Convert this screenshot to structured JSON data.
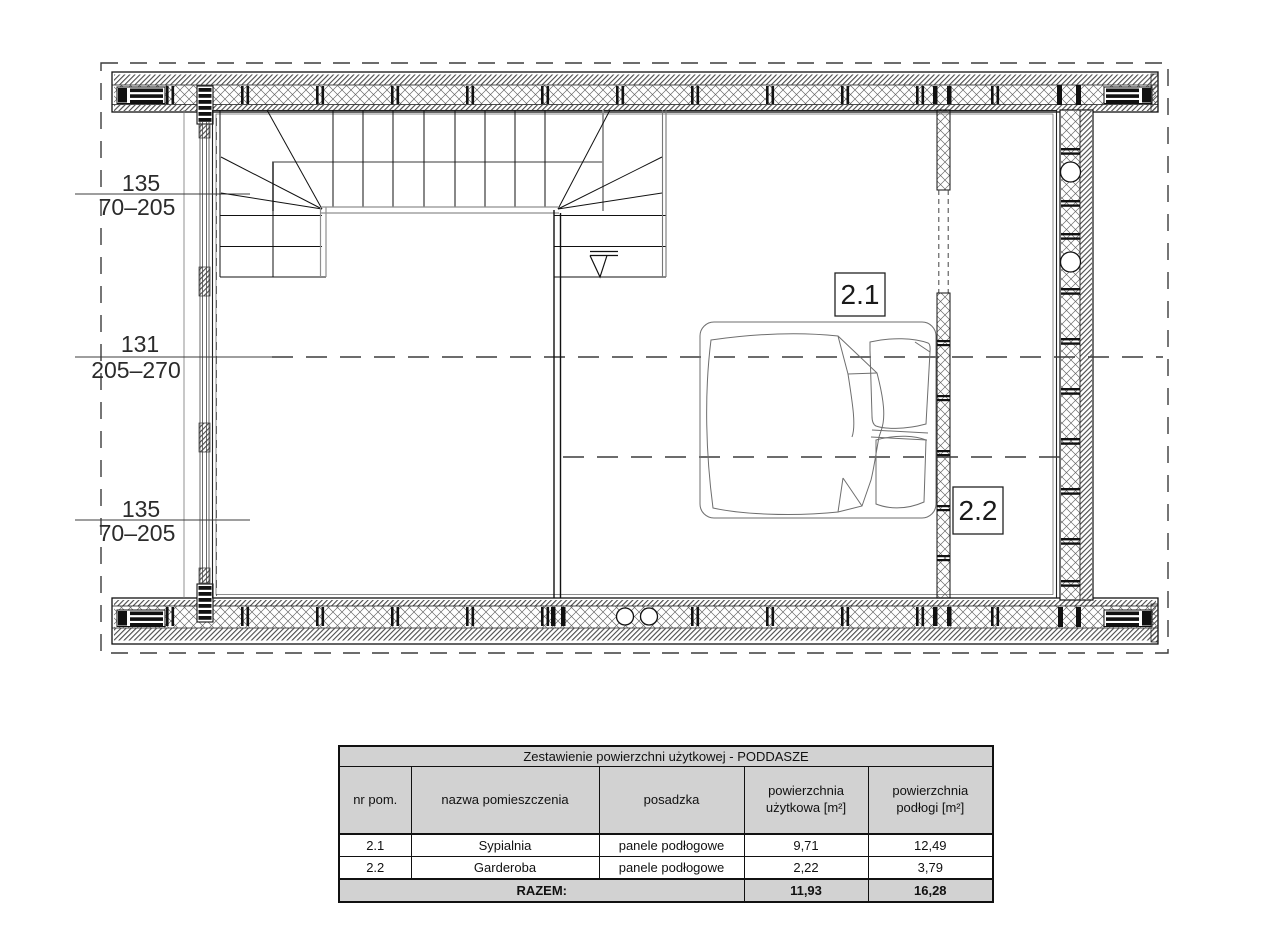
{
  "plan": {
    "dimension_labels": [
      {
        "height": "135",
        "range": "70–205"
      },
      {
        "height": "131",
        "range": "205–270"
      },
      {
        "height": "135",
        "range": "70–205"
      }
    ],
    "room_labels": {
      "bedroom": "2.1",
      "wardrobe": "2.2"
    }
  },
  "table": {
    "title": "Zestawienie powierzchni użytkowej - PODDASZE",
    "columns": [
      "nr pom.",
      "nazwa pomieszczenia",
      "posadzka",
      "powierzchnia użytkowa [m²]",
      "powierzchnia podłogi [m²]"
    ],
    "rows": [
      {
        "nr": "2.1",
        "name": "Sypialnia",
        "floor": "panele podłogowe",
        "usable": "9,71",
        "floor_area": "12,49"
      },
      {
        "nr": "2.2",
        "name": "Garderoba",
        "floor": "panele podłogowe",
        "usable": "2,22",
        "floor_area": "3,79"
      }
    ],
    "total": {
      "label": "RAZEM:",
      "usable": "11,93",
      "floor_area": "16,28"
    }
  },
  "colors": {
    "table_header_bg": "#d2d2d2",
    "line": "#111111"
  }
}
